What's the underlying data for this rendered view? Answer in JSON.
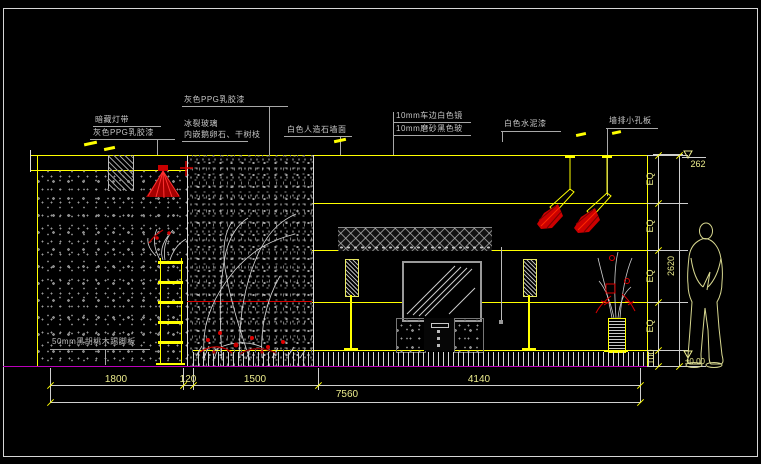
{
  "labels": {
    "hidden_light": "暗藏灯带",
    "gray_ppg_left": "灰色PPG乳胶漆",
    "gray_ppg_top": "灰色PPG乳胶漆",
    "crackle_glass": "冰裂玻璃",
    "inlay": "内嵌鹅卵石、干树枝",
    "stone_counter": "白色人造石墙面",
    "mirror_10mm": "10mm车边白色镜",
    "glass_10mm": "10mm磨砂黑色玻",
    "white_cement": "白色水泥漆",
    "perforated": "墙排小孔板",
    "skirting": "50mm黑胡桃木踢脚板"
  },
  "dimensions": {
    "d1800": "1800",
    "d120": "120",
    "d1500": "1500",
    "d4140": "4140",
    "total": "7560",
    "eq": "EQ",
    "h100": "100",
    "htotal": "2620",
    "level_top": "262",
    "level_floor": "±0.00"
  },
  "colors": {
    "line_yellow": "#ffff00",
    "red": "#d80000",
    "magenta": "#bb00bb",
    "dim_text": "#ecec8c",
    "annotation_text": "#c6c6c6",
    "figure": "#d8d890"
  }
}
